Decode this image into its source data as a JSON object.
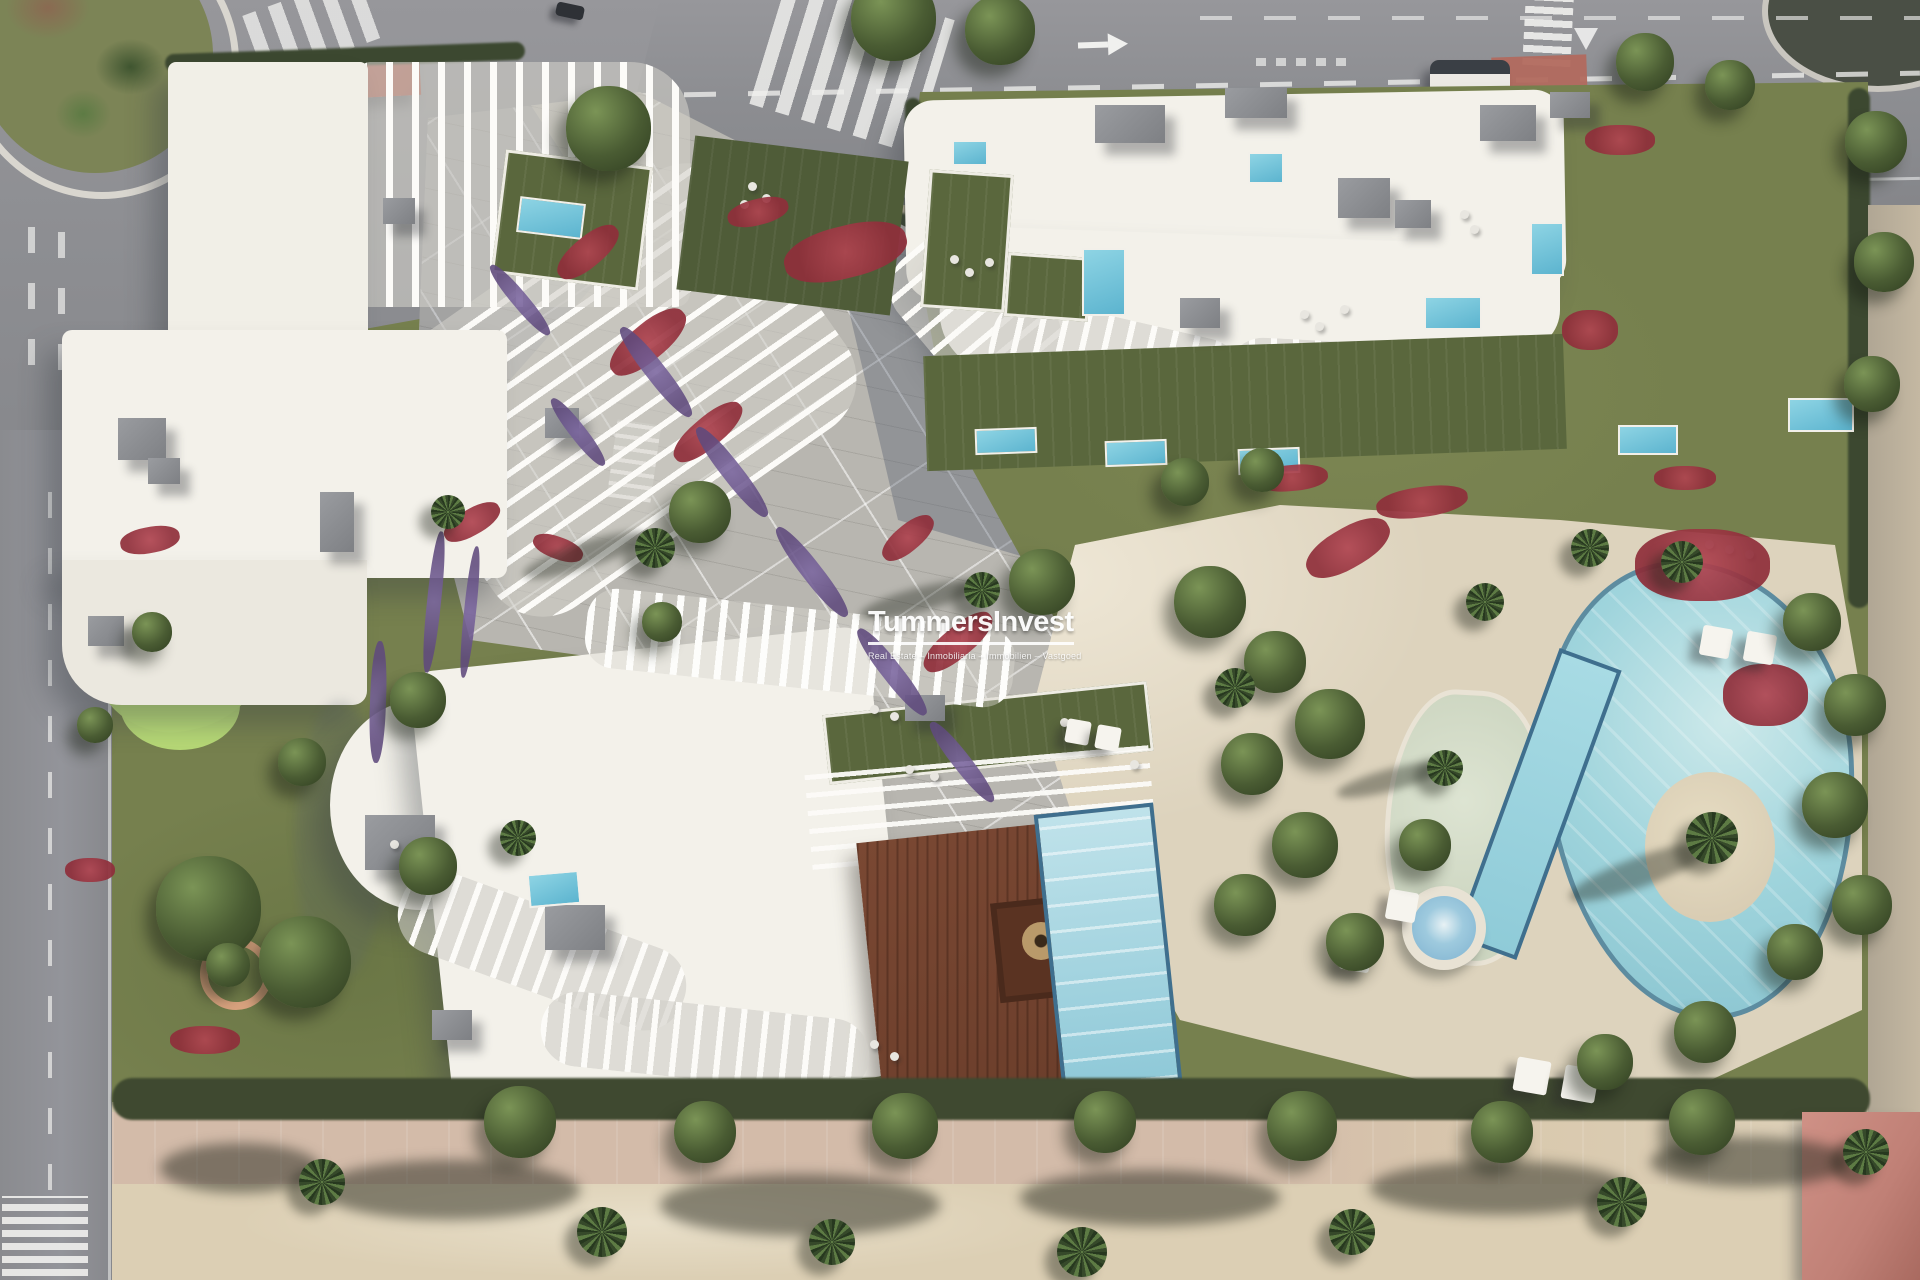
{
  "watermark": {
    "title": "TummersInvest",
    "subtitle": "Real Estate – Inmobiliaria – Immobilien – Vastgoed"
  },
  "scene": {
    "type": "aerial-3d-render",
    "description": "Top-down aerial 3D render of a beachfront residential development: three white apartment buildings with wavy louver balconies, landscaped gardens with red and purple flower beds, a diagonal paved central plaza, a free-form swimming pool with lap pool, lagoon ledge, palm island and jacuzzi, rooftop terraces with private plunge pools, a mini-golf garden, roads with roundabout, crosswalks and a bus, and a sandy beach promenade with palms along the bottom.",
    "landmarks": [
      "roundabout-with-cacti",
      "top-road",
      "left-road",
      "crosswalks",
      "bus",
      "bus-stop-red-pavement",
      "north-west-building",
      "north-east-building",
      "south-building",
      "central-plaza",
      "main-pool",
      "lap-pool",
      "lagoon-pool",
      "jacuzzi",
      "pool-island",
      "rooftop-pools",
      "wooden-deck",
      "fire-pit-lounge",
      "mini-golf",
      "beach-promenade",
      "palm-trees"
    ]
  },
  "colors": {
    "ground": "#cfc3a9",
    "asphalt": "#8d8e92",
    "concrete": "#b8b6b0",
    "parcel": "#76804e",
    "lawn": "#5a673d",
    "hedge": "#3c4830",
    "golf": "#b9dc78",
    "roof": "#f3f1ea",
    "terrace": "#ddd3bd",
    "pool": "#9fd4dc",
    "pool-rim": "#5d8ca0",
    "small-pool": "#5cb4cf",
    "deck": "#6b3e2b",
    "island": "#d9cdb4",
    "sand": "#dccfb4",
    "path-pink": "#d3bba9",
    "flower-red": "#8f2e3a",
    "flower-purple": "#5f4a7d",
    "red-roof": "#a8584a",
    "red-pad": "#b26a5e",
    "watermark": "#ffffff"
  },
  "vegetation": {
    "trees": [
      [
        893,
        18,
        85
      ],
      [
        1000,
        30,
        70
      ],
      [
        608,
        128,
        85
      ],
      [
        700,
        512,
        62
      ],
      [
        1042,
        582,
        66
      ],
      [
        208,
        908,
        105
      ],
      [
        305,
        962,
        92
      ],
      [
        418,
        700,
        56
      ],
      [
        302,
        762,
        48
      ],
      [
        428,
        866,
        58
      ],
      [
        1876,
        142,
        62
      ],
      [
        1884,
        262,
        60
      ],
      [
        1872,
        384,
        56
      ],
      [
        1645,
        62,
        58
      ],
      [
        1730,
        85,
        50
      ],
      [
        1185,
        482,
        48
      ],
      [
        1262,
        470,
        44
      ],
      [
        1210,
        602,
        72
      ],
      [
        1275,
        662,
        62
      ],
      [
        1330,
        724,
        70
      ],
      [
        1252,
        764,
        62
      ],
      [
        1305,
        845,
        66
      ],
      [
        1245,
        905,
        62
      ],
      [
        1355,
        942,
        58
      ],
      [
        1425,
        845,
        52
      ],
      [
        1812,
        622,
        58
      ],
      [
        1855,
        705,
        62
      ],
      [
        1835,
        805,
        66
      ],
      [
        1862,
        905,
        60
      ],
      [
        1795,
        952,
        56
      ],
      [
        1705,
        1032,
        62
      ],
      [
        1605,
        1062,
        56
      ],
      [
        520,
        1122,
        72
      ],
      [
        705,
        1132,
        62
      ],
      [
        905,
        1126,
        66
      ],
      [
        1105,
        1122,
        62
      ],
      [
        1302,
        1126,
        70
      ],
      [
        1502,
        1132,
        62
      ],
      [
        1702,
        1122,
        66
      ],
      [
        662,
        622,
        40
      ],
      [
        152,
        632,
        40
      ],
      [
        228,
        965,
        44
      ],
      [
        95,
        725,
        36
      ]
    ],
    "palms": [
      [
        655,
        548,
        40
      ],
      [
        982,
        590,
        36
      ],
      [
        1485,
        602,
        38
      ],
      [
        1590,
        548,
        38
      ],
      [
        1682,
        562,
        42
      ],
      [
        1712,
        838,
        52
      ],
      [
        1445,
        768,
        36
      ],
      [
        1235,
        688,
        40
      ],
      [
        448,
        512,
        34
      ],
      [
        518,
        838,
        36
      ],
      [
        322,
        1182,
        46
      ],
      [
        602,
        1232,
        50
      ],
      [
        832,
        1242,
        46
      ],
      [
        1082,
        1252,
        50
      ],
      [
        1352,
        1232,
        46
      ],
      [
        1622,
        1202,
        50
      ],
      [
        1866,
        1152,
        46
      ]
    ],
    "flowers": [
      [
        588,
        252,
        74,
        30,
        -40,
        "red"
      ],
      [
        648,
        342,
        92,
        36,
        -40,
        "red"
      ],
      [
        708,
        432,
        84,
        30,
        -40,
        "red"
      ],
      [
        472,
        522,
        62,
        26,
        -30,
        "red"
      ],
      [
        558,
        548,
        52,
        22,
        20,
        "red"
      ],
      [
        908,
        538,
        62,
        26,
        -40,
        "red"
      ],
      [
        958,
        642,
        84,
        30,
        -40,
        "red"
      ],
      [
        845,
        252,
        125,
        52,
        -14,
        "red"
      ],
      [
        758,
        212,
        62,
        26,
        -14,
        "red"
      ],
      [
        1292,
        478,
        72,
        26,
        -5,
        "red"
      ],
      [
        1422,
        502,
        92,
        30,
        -8,
        "red"
      ],
      [
        1685,
        478,
        62,
        24,
        0,
        "red"
      ],
      [
        1702,
        565,
        135,
        72,
        0,
        "red"
      ],
      [
        1765,
        695,
        85,
        62,
        0,
        "red"
      ],
      [
        1348,
        548,
        92,
        40,
        -30,
        "red"
      ],
      [
        150,
        540,
        60,
        26,
        -10,
        "red"
      ],
      [
        90,
        870,
        50,
        24,
        0,
        "red"
      ],
      [
        205,
        1040,
        70,
        28,
        0,
        "red"
      ],
      [
        1620,
        140,
        70,
        30,
        0,
        "red"
      ],
      [
        1590,
        330,
        56,
        40,
        0,
        "red"
      ],
      [
        656,
        372,
        20,
        112,
        -38,
        "purple"
      ],
      [
        732,
        472,
        20,
        112,
        -38,
        "purple"
      ],
      [
        812,
        572,
        20,
        112,
        -38,
        "purple"
      ],
      [
        892,
        672,
        20,
        108,
        -38,
        "purple"
      ],
      [
        962,
        762,
        18,
        100,
        -38,
        "purple"
      ],
      [
        578,
        432,
        16,
        84,
        -38,
        "purple"
      ],
      [
        434,
        602,
        14,
        142,
        6,
        "purple"
      ],
      [
        470,
        612,
        12,
        132,
        6,
        "purple"
      ],
      [
        378,
        702,
        16,
        122,
        2,
        "purple"
      ],
      [
        520,
        300,
        16,
        90,
        -40,
        "purple"
      ]
    ],
    "palm_shadows": [
      [
        585,
        555,
        130,
        26,
        -18
      ],
      [
        918,
        600,
        120,
        24,
        -15
      ],
      [
        1640,
        872,
        150,
        30,
        -20
      ],
      [
        1390,
        780,
        110,
        22,
        -15
      ]
    ],
    "beach_shadows": [
      [
        450,
        1190,
        260,
        60
      ],
      [
        800,
        1205,
        280,
        62
      ],
      [
        1150,
        1198,
        260,
        56
      ],
      [
        1500,
        1188,
        260,
        54
      ],
      [
        240,
        1168,
        160,
        50
      ],
      [
        1750,
        1162,
        200,
        50
      ]
    ]
  },
  "furniture": {
    "umbrellas": [
      [
        1716,
        642,
        30
      ],
      [
        1760,
        648,
        30
      ],
      [
        1532,
        1076,
        34
      ],
      [
        1580,
        1084,
        34
      ],
      [
        1402,
        906,
        30
      ],
      [
        1356,
        956,
        30
      ],
      [
        1078,
        732,
        24
      ],
      [
        1108,
        738,
        24
      ]
    ],
    "rooftop_units": [
      [
        118,
        418,
        48,
        42
      ],
      [
        148,
        458,
        32,
        26
      ],
      [
        320,
        492,
        34,
        60
      ],
      [
        383,
        198,
        32,
        26
      ],
      [
        545,
        408,
        34,
        30
      ],
      [
        88,
        616,
        36,
        30
      ],
      [
        1095,
        105,
        70,
        38
      ],
      [
        1225,
        88,
        62,
        30
      ],
      [
        1338,
        178,
        52,
        40
      ],
      [
        1480,
        105,
        56,
        36
      ],
      [
        1180,
        298,
        40,
        30
      ],
      [
        1395,
        200,
        36,
        28
      ],
      [
        365,
        815,
        70,
        55
      ],
      [
        545,
        905,
        60,
        45
      ],
      [
        432,
        1010,
        40,
        30
      ],
      [
        905,
        695,
        40,
        26
      ],
      [
        1550,
        92,
        40,
        26
      ]
    ],
    "rooftop_pools": [
      [
        518,
        200,
        62,
        32,
        7
      ],
      [
        975,
        428,
        58,
        22,
        -2
      ],
      [
        1105,
        440,
        58,
        22,
        -2
      ],
      [
        1238,
        448,
        58,
        22,
        -2
      ],
      [
        1082,
        248,
        40,
        64,
        0
      ],
      [
        1248,
        152,
        32,
        28,
        0
      ],
      [
        1424,
        296,
        54,
        30,
        0
      ],
      [
        1530,
        222,
        30,
        50,
        0
      ],
      [
        1618,
        425,
        56,
        26,
        0
      ],
      [
        1788,
        398,
        62,
        30,
        0
      ],
      [
        952,
        140,
        32,
        22,
        0
      ],
      [
        528,
        872,
        48,
        30,
        -5
      ]
    ],
    "dots": [
      [
        950,
        255
      ],
      [
        965,
        268
      ],
      [
        985,
        258
      ],
      [
        1300,
        310
      ],
      [
        1315,
        322
      ],
      [
        1340,
        305
      ],
      [
        1460,
        210
      ],
      [
        1470,
        225
      ],
      [
        748,
        182
      ],
      [
        762,
        194
      ],
      [
        740,
        200
      ],
      [
        870,
        705
      ],
      [
        890,
        712
      ],
      [
        1060,
        718
      ],
      [
        390,
        840
      ],
      [
        405,
        852
      ],
      [
        870,
        1040
      ],
      [
        890,
        1052
      ],
      [
        1705,
        540
      ],
      [
        1725,
        545
      ],
      [
        1745,
        550
      ],
      [
        905,
        765
      ],
      [
        930,
        772
      ],
      [
        1130,
        760
      ]
    ]
  }
}
